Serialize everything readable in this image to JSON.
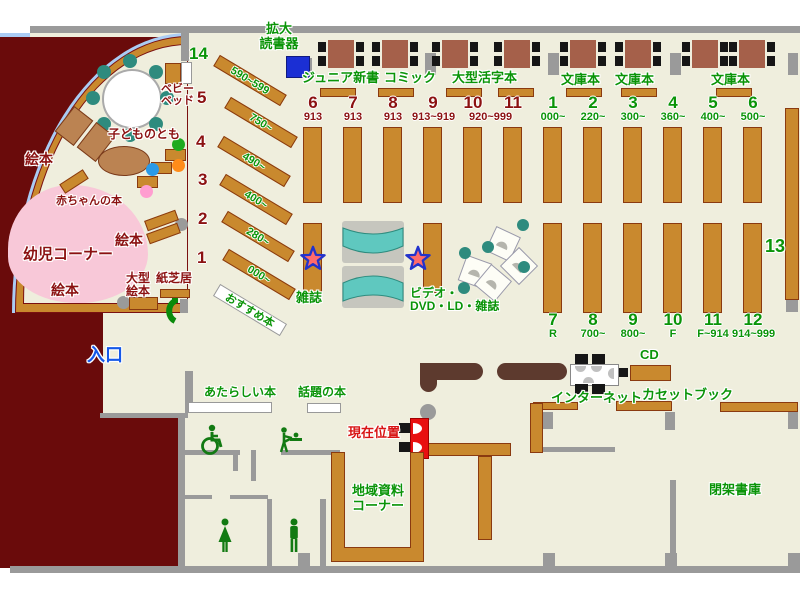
{
  "colors": {
    "floor": "#efeedd",
    "outside": "#6a0b0b",
    "wall": "#9a9a9a",
    "shelf": "#c9892e",
    "table": "#a5604a",
    "green_text": "#0a9408",
    "darkred_text": "#8b1111",
    "entrance_blue": "#1558e8",
    "current_red": "#e81010",
    "arc_blue": "#aaccf4",
    "kids_pink": "#f8c8d8",
    "teal": "#2e8b7e",
    "device_blue": "#1b2fd4"
  },
  "labels": {
    "device": "拡大\n読書器",
    "entrance": "入口",
    "junior": "ジュニア新書",
    "comic": "コミック",
    "large_print": "大型活字本",
    "bunko": "文庫本",
    "magazines": "雑誌",
    "video": "ビデオ・\nDVD・LD・雑誌",
    "internet": "インターネット",
    "cd": "CD",
    "cassette": "カセットブック",
    "local": "地域資料\nコーナー",
    "closed_stacks": "閉架書庫",
    "new_books": "あたらしい本",
    "topic_books": "話題の本",
    "current_pos": "現在位置",
    "recommended": "おすすめ本",
    "baby_books": "赤ちゃんの本",
    "toddler_corner": "幼児コーナー",
    "picture_books": "絵本",
    "large_picture": "大型\n絵本",
    "kamishibai": "紙芝居",
    "kodomo": "子どものとも",
    "baby_bed": "ベビー\nベッド",
    "sec13": "13"
  },
  "misc_labels": [
    {
      "name": "zoom-reader-label",
      "text": "拡大\n読書器",
      "style": "left:256px;top:22px;width:46px"
    },
    {
      "name": "entrance-label",
      "text": "入口",
      "style": "left:87px;top:345px;font-size:18px;color:#1558e8"
    },
    {
      "name": "junior-shinsho-label",
      "text": "ジュニア新書",
      "style": "left:302px;top:71px"
    },
    {
      "name": "comic-label",
      "text": "コミック",
      "style": "left:384px;top:71px"
    },
    {
      "name": "large-print-label",
      "text": "大型活字本",
      "style": "left:452px;top:71px"
    },
    {
      "name": "bunko-label-1",
      "text": "文庫本",
      "style": "left:561px;top:73px"
    },
    {
      "name": "bunko-label-2",
      "text": "文庫本",
      "style": "left:615px;top:73px"
    },
    {
      "name": "bunko-label-3",
      "text": "文庫本",
      "style": "left:711px;top:73px"
    },
    {
      "name": "magazines-label",
      "text": "雑誌",
      "style": "left:296px;top:291px"
    },
    {
      "name": "video-dvd-label",
      "text": "ビデオ・\nDVD・LD・雑誌",
      "style": "left:410px;top:287px;font-size:12px;text-align:left"
    },
    {
      "name": "internet-label",
      "text": "インターネット",
      "style": "left:551px;top:391px"
    },
    {
      "name": "cd-label",
      "text": "CD",
      "style": "left:640px;top:348px"
    },
    {
      "name": "cassette-book-label",
      "text": "カセットブック",
      "style": "left:642px;top:388px"
    },
    {
      "name": "local-materials-label",
      "text": "地域資料\nコーナー",
      "style": "left:347px;top:484px;width:62px"
    },
    {
      "name": "closed-stacks-label",
      "text": "閉架書庫",
      "style": "left:709px;top:483px"
    },
    {
      "name": "new-books-label",
      "text": "あたらしい本",
      "style": "left:204px;top:386px;font-size:12px"
    },
    {
      "name": "topic-books-label",
      "text": "話題の本",
      "style": "left:298px;top:386px;font-size:12px"
    },
    {
      "name": "current-position-label",
      "text": "現在位置",
      "style": "left:348px;top:426px;color:#d81414"
    },
    {
      "name": "section-13-label",
      "text": "13",
      "style": "left:765px;top:236px;font-size:18px"
    },
    {
      "name": "kodomo-no-tomo-label",
      "text": "子どものとも",
      "style": "left:108px;top:128px;font-size:12px;color:#8b1111"
    },
    {
      "name": "baby-books-label",
      "text": "赤ちゃんの本",
      "style": "left:56px;top:195px;font-size:11px;color:#8b1111"
    },
    {
      "name": "toddler-corner-label",
      "text": "幼児コーナー",
      "style": "left:23px;top:247px;font-size:15px;color:#8b1111"
    },
    {
      "name": "picture-books-label-1",
      "text": "絵本",
      "style": "left:25px;top:152px;font-size:14px;color:#8b1111"
    },
    {
      "name": "picture-books-label-2",
      "text": "絵本",
      "style": "left:115px;top:233px;font-size:14px;color:#8b1111"
    },
    {
      "name": "picture-books-label-3",
      "text": "絵本",
      "style": "left:51px;top:283px;font-size:14px;color:#8b1111"
    },
    {
      "name": "large-picture-books-label",
      "text": "大型\n絵本",
      "style": "left:126px;top:272px;font-size:12px;color:#8b1111"
    },
    {
      "name": "kamishibai-label",
      "text": "紙芝居",
      "style": "left:156px;top:272px;font-size:12px;color:#8b1111"
    },
    {
      "name": "baby-bed-label",
      "text": "ベビー\nベッド",
      "style": "left:161px;top:83px;font-size:11px;color:#8b1111"
    }
  ],
  "left_sections": [
    {
      "num": "14",
      "range": "590~599",
      "num_style": "left:189px;top:45px;color:#0a9408",
      "bar_style": "left:211px;top:74px"
    },
    {
      "num": "5",
      "range": "750~",
      "num_style": "left:197px;top:89px;color:#8b1111",
      "bar_style": "left:222px;top:116px"
    },
    {
      "num": "4",
      "range": "490~",
      "num_style": "left:196px;top:133px;color:#8b1111",
      "bar_style": "left:215px;top:155px"
    },
    {
      "num": "3",
      "range": "400~",
      "num_style": "left:198px;top:171px;color:#8b1111",
      "bar_style": "left:217px;top:193px"
    },
    {
      "num": "2",
      "range": "280~",
      "num_style": "left:198px;top:210px;color:#8b1111",
      "bar_style": "left:219px;top:230px"
    },
    {
      "num": "1",
      "range": "000~",
      "num_style": "left:197px;top:249px;color:#8b1111",
      "bar_style": "left:220px;top:268px"
    }
  ],
  "mid_sections": [
    {
      "num": "6",
      "range": "913",
      "style": "left:292px"
    },
    {
      "num": "7",
      "range": "913",
      "style": "left:332px"
    },
    {
      "num": "8",
      "range": "913",
      "style": "left:372px"
    },
    {
      "num": "9",
      "range": "913~919",
      "style": "left:412px"
    },
    {
      "num": "10",
      "range": "920~999",
      "style": "left:452px",
      "range_style": "left:17px"
    },
    {
      "num": "11",
      "range": "",
      "style": "left:492px"
    }
  ],
  "right_top_sections": [
    {
      "num": "1",
      "range": "000~",
      "style": "left:532px"
    },
    {
      "num": "2",
      "range": "220~",
      "style": "left:572px"
    },
    {
      "num": "3",
      "range": "300~",
      "style": "left:612px"
    },
    {
      "num": "4",
      "range": "360~",
      "style": "left:652px"
    },
    {
      "num": "5",
      "range": "400~",
      "style": "left:692px"
    },
    {
      "num": "6",
      "range": "500~",
      "style": "left:732px"
    }
  ],
  "right_bottom_sections": [
    {
      "num": "7",
      "range": "R",
      "style": "left:532px"
    },
    {
      "num": "8",
      "range": "700~",
      "style": "left:572px"
    },
    {
      "num": "9",
      "range": "800~",
      "style": "left:612px"
    },
    {
      "num": "10",
      "range": "F",
      "style": "left:652px"
    },
    {
      "num": "11",
      "range": "F~914",
      "style": "left:692px"
    },
    {
      "num": "12",
      "range": "914~999",
      "style": "left:732px"
    }
  ],
  "tables": [
    {
      "style": "left:328px"
    },
    {
      "style": "left:382px"
    },
    {
      "style": "left:442px"
    },
    {
      "style": "left:504px"
    },
    {
      "style": "left:570px"
    },
    {
      "style": "left:625px"
    },
    {
      "style": "left:692px"
    },
    {
      "style": "left:739px"
    }
  ],
  "walls": [
    {
      "style": "left:30px;top:26px;width:770px;height:7px"
    },
    {
      "style": "left:10px;top:566px;width:790px;height:7px"
    },
    {
      "style": "left:181px;top:33px;width:8px;height:28px"
    },
    {
      "style": "left:100px;top:413px;width:88px;height:5px"
    },
    {
      "style": "left:178px;top:418px;width:7px;height:148px"
    },
    {
      "style": "left:185px;top:371px;width:8px;height:42px"
    },
    {
      "style": "left:184px;top:450px;width:56px;height:5px"
    },
    {
      "style": "left:233px;top:455px;width:5px;height:16px"
    },
    {
      "style": "left:251px;top:450px;width:5px;height:31px"
    },
    {
      "style": "left:281px;top:450px;width:59px;height:5px"
    },
    {
      "style": "left:184px;top:495px;width:28px;height:4px"
    },
    {
      "style": "left:230px;top:495px;width:38px;height:4px"
    },
    {
      "style": "left:267px;top:499px;width:5px;height:67px"
    },
    {
      "style": "left:320px;top:499px;width:6px;height:67px"
    },
    {
      "style": "left:543px;top:447px;width:72px;height:5px"
    },
    {
      "style": "left:670px;top:480px;width:6px;height:86px"
    }
  ],
  "pillars": [
    {
      "style": "left:425px;top:53px;width:11px;height:22px"
    },
    {
      "style": "left:548px;top:53px;width:11px;height:22px"
    },
    {
      "style": "left:670px;top:53px;width:11px;height:22px"
    },
    {
      "style": "left:788px;top:53px;width:10px;height:22px"
    },
    {
      "style": "left:302px;top:58px;width:10px;height:19px"
    },
    {
      "style": "left:543px;top:412px;width:10px;height:17px"
    },
    {
      "style": "left:665px;top:412px;width:10px;height:18px"
    },
    {
      "style": "left:788px;top:412px;width:10px;height:17px"
    },
    {
      "style": "left:786px;top:298px;width:12px;height:14px"
    },
    {
      "style": "left:298px;top:553px;width:12px;height:13px"
    },
    {
      "style": "left:543px;top:553px;width:12px;height:13px"
    },
    {
      "style": "left:665px;top:553px;width:12px;height:13px"
    },
    {
      "style": "left:788px;top:553px;width:12px;height:13px"
    },
    {
      "style": "left:180px;top:299px;width:8px;height:14px"
    }
  ],
  "shelves": [
    {
      "style": "left:320px;top:88px;width:36px;height:9px"
    },
    {
      "style": "left:378px;top:88px;width:36px;height:9px"
    },
    {
      "style": "left:446px;top:88px;width:36px;height:9px"
    },
    {
      "style": "left:498px;top:88px;width:36px;height:9px"
    },
    {
      "style": "left:566px;top:88px;width:36px;height:9px"
    },
    {
      "style": "left:621px;top:88px;width:36px;height:9px"
    },
    {
      "style": "left:716px;top:88px;width:36px;height:9px"
    },
    {
      "style": "left:303px;top:223px;width:19px;height:70px"
    },
    {
      "style": "left:423px;top:223px;width:19px;height:70px"
    },
    {
      "style": "left:785px;top:108px;width:14px;height:192px"
    },
    {
      "style": "left:160px;top:289px;width:30px;height:9px"
    },
    {
      "style": "left:129px;top:297px;width:29px;height:13px"
    },
    {
      "style": "left:165px;top:63px;width:16px;height:21px"
    },
    {
      "style": "left:630px;top:365px;width:41px;height:16px"
    },
    {
      "style": "left:616px;top:401px;width:56px;height:10px"
    },
    {
      "style": "left:720px;top:402px;width:78px;height:10px"
    },
    {
      "style": "left:533px;top:402px;width:45px;height:8px"
    },
    {
      "style": "left:530px;top:403px;width:13px;height:50px"
    },
    {
      "style": "left:427px;top:443px;width:84px;height:13px"
    },
    {
      "style": "left:478px;top:456px;width:14px;height:84px"
    }
  ],
  "steps": [
    {
      "style": "left:165px;top:149px"
    },
    {
      "style": "left:151px;top:162px"
    },
    {
      "style": "left:137px;top:176px"
    }
  ],
  "color_dots": [
    {
      "style": "left:172px;top:138px;width:13px;height:13px;background:#1faa1f"
    },
    {
      "style": "left:172px;top:159px;width:13px;height:13px;background:#ff8c1a"
    },
    {
      "style": "left:146px;top:163px;width:13px;height:13px;background:#2a9ae8"
    },
    {
      "style": "left:140px;top:185px;width:13px;height:13px;background:#ff9ed0"
    }
  ]
}
